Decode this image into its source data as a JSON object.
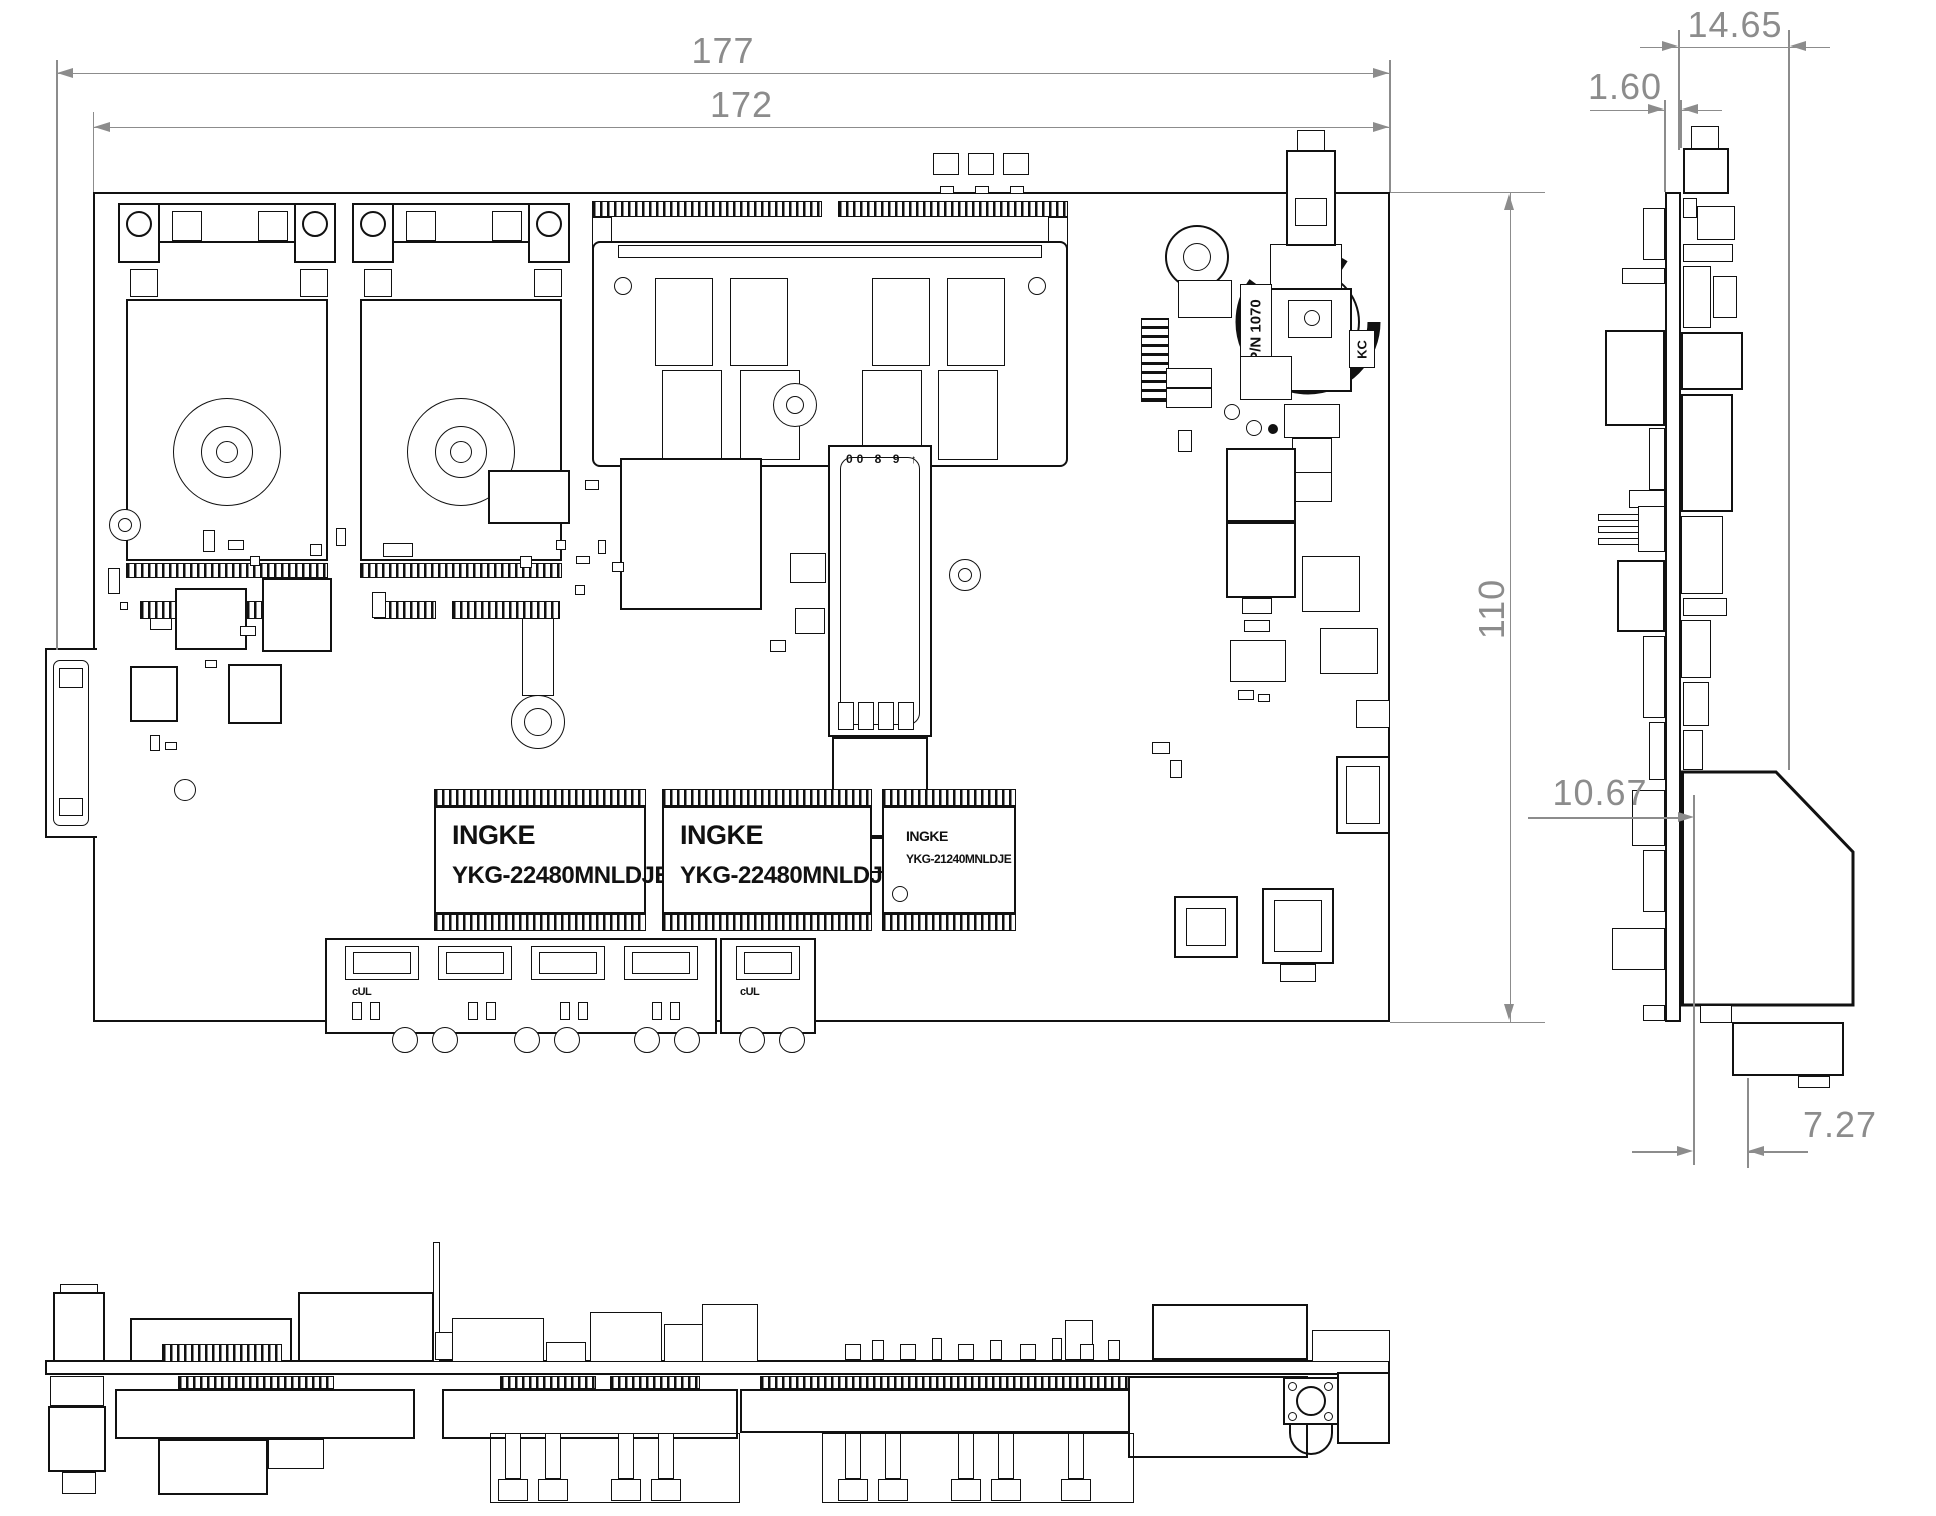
{
  "dims": {
    "d177": "177",
    "d172": "172",
    "d110": "110",
    "d1465": "14.65",
    "d160": "1.60",
    "d1067": "10.67",
    "d727": "7.27"
  },
  "chips": {
    "t1_brand": "INGKE",
    "t1_part": "YKG-22480MNLDJE",
    "t2_brand": "INGKE",
    "t2_part": "YKG-22480MNLDJE",
    "t3_brand": "INGKE",
    "t3_part": "YKG-21240MNLDJE"
  },
  "markings": {
    "battery_pn": "P/N 1070",
    "battery_cert": "KC",
    "sfp": "00 8 9 ↑",
    "cert": "cUL"
  },
  "colors": {
    "line": "#111111",
    "dimension": "#8c8c8c",
    "background": "#ffffff"
  }
}
